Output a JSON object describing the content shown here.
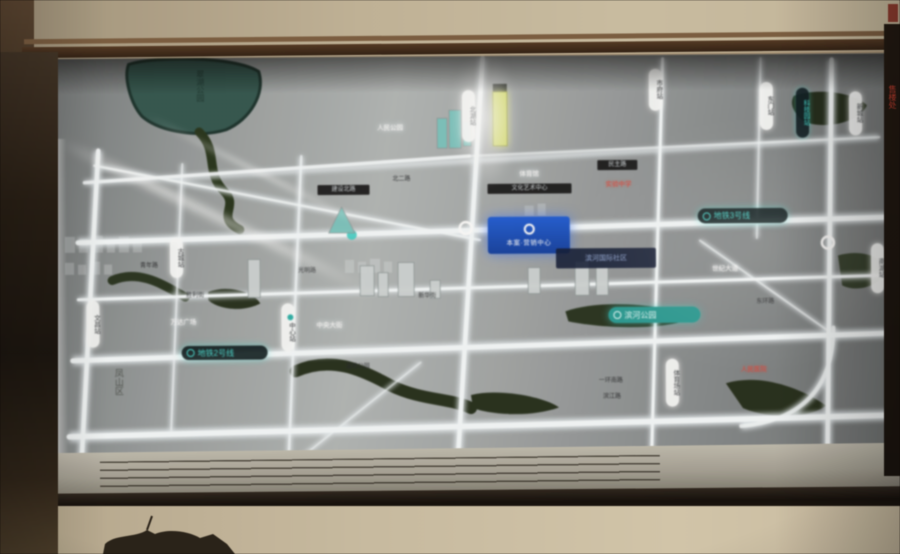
{
  "scene": {
    "title": "楼盘区位沙盘灯光地图",
    "surface": "backlit-map-board-photo"
  },
  "labels": {
    "district": "凤山区",
    "lake": "翠湖公园",
    "banner": "滨河国际社区",
    "project_sign": "本案·营销中心",
    "park": "湿地公园",
    "white_1": "人民公园",
    "white_2": "万达广场",
    "white_3": "中央大街",
    "white_4": "世纪大道",
    "white_5": "体育馆",
    "plate_1": "建设北路",
    "plate_2": "文化艺术中心",
    "plate_3": "民主路",
    "road_1": "青年路",
    "road_2": "胜利街",
    "road_3": "光明路",
    "road_4": "新华街",
    "road_5": "一环南路",
    "road_6": "滨江路",
    "road_7": "东环路",
    "road_8": "北二路",
    "red_school": "实验中学",
    "red_hospital": "人民医院",
    "red_sales": "售楼处"
  },
  "stations": [
    {
      "label": "文昌站"
    },
    {
      "label": "古城站"
    },
    {
      "label": "中心站"
    },
    {
      "label": "北湖站"
    },
    {
      "label": "市府站"
    },
    {
      "label": "东门站"
    },
    {
      "label": "科技园站"
    },
    {
      "label": "南湖站"
    },
    {
      "label": "体育场站"
    },
    {
      "label": "新城站"
    }
  ],
  "badges": [
    {
      "label": "地铁3号线",
      "style": "dark-cyan"
    },
    {
      "label": "地铁2号线",
      "style": "dark-cyan"
    },
    {
      "label": "滨河公园",
      "style": "teal"
    }
  ],
  "colors": {
    "road_glow": "#eef6fb",
    "metro_cyan": "#3fd9cf",
    "project_blue": "#1a5de0",
    "alert_red": "#e8443a",
    "park_green": "#26331e",
    "lake_teal": "#2e564e",
    "wall_beige": "#c3b498",
    "frame_brown": "#4a2f1b",
    "landmark_yellow": "#d8e06a"
  }
}
